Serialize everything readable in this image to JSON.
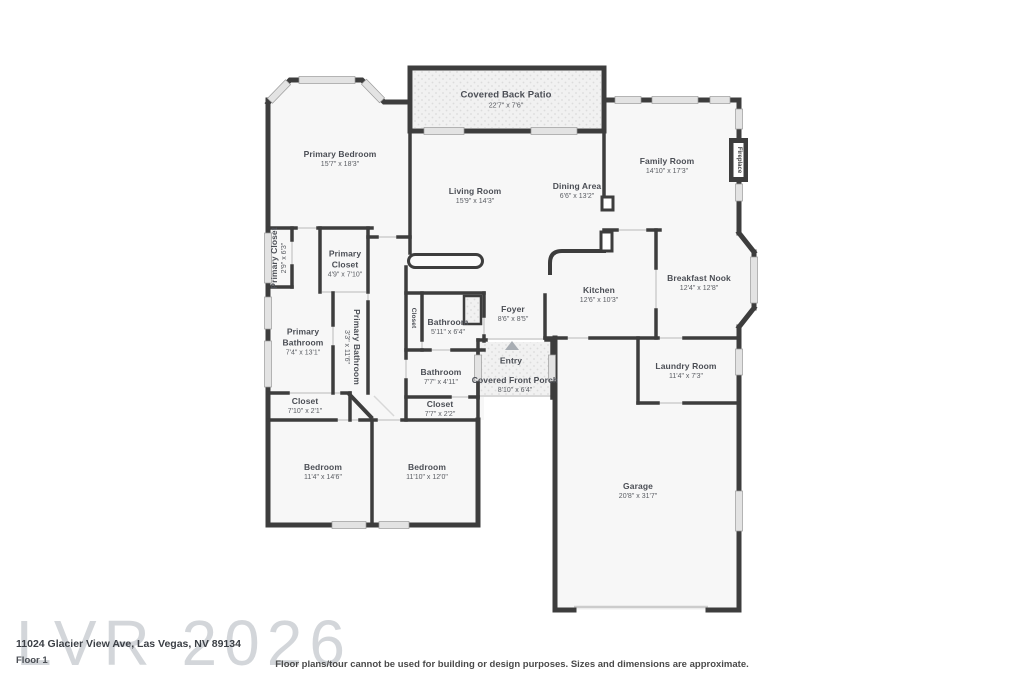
{
  "watermark": "LVR 2026",
  "address": {
    "line1": "11024 Glacier View Ave, Las Vegas, NV 89134",
    "line2": "Floor 1"
  },
  "footer": {
    "disclaimer": "Floor plans/tour cannot be used for building or design purposes. Sizes and dimensions are approximate."
  },
  "colors": {
    "wall": "#3d3d3d",
    "floor": "#f7f7f7",
    "patio_fill": "#f1f1f1",
    "window": "#e3e3e3",
    "label_text": "#4b4e55",
    "watermark": "#b7bcc2"
  },
  "rooms": {
    "covered_back_patio": {
      "name": "Covered Back Patio",
      "dims": "22'7\" x 7'6\""
    },
    "primary_bedroom": {
      "name": "Primary Bedroom",
      "dims": "15'7\" x 18'3\""
    },
    "family_room": {
      "name": "Family Room",
      "dims": "14'10\" x 17'3\""
    },
    "living_room": {
      "name": "Living Room",
      "dims": "15'9\" x 14'3\""
    },
    "dining_area": {
      "name": "Dining Area",
      "dims": "6'6\" x 13'2\""
    },
    "breakfast_nook": {
      "name": "Breakfast Nook",
      "dims": "12'4\" x 12'8\""
    },
    "kitchen": {
      "name": "Kitchen",
      "dims": "12'6\" x 10'3\""
    },
    "primary_closet_left": {
      "name": "Primary Closet",
      "dims": "2'9\" x 6'3\""
    },
    "primary_closet": {
      "name": "Primary Closet",
      "dims": "4'9\" x 7'10\""
    },
    "primary_bathroom": {
      "name": "Primary Bathroom",
      "dims": "7'4\" x 13'1\""
    },
    "primary_bathroom_hall": {
      "name": "Primary Bathroom",
      "dims": "3'3\" x 11'6\""
    },
    "closet_hall": {
      "name": "Closet"
    },
    "bathroom_upper": {
      "name": "Bathroom",
      "dims": "5'11\" x 6'4\""
    },
    "foyer": {
      "name": "Foyer",
      "dims": "8'6\" x 8'5\""
    },
    "entry": {
      "name": "Entry"
    },
    "covered_front_porch": {
      "name": "Covered Front Porch",
      "dims": "8'10\" x 6'4\""
    },
    "bathroom_lower": {
      "name": "Bathroom",
      "dims": "7'7\" x 4'11\""
    },
    "closet_lower": {
      "name": "Closet",
      "dims": "7'7\" x 2'2\""
    },
    "closet_left": {
      "name": "Closet",
      "dims": "7'10\" x 2'1\""
    },
    "bedroom_left": {
      "name": "Bedroom",
      "dims": "11'4\" x 14'6\""
    },
    "bedroom_right": {
      "name": "Bedroom",
      "dims": "11'10\" x 12'0\""
    },
    "laundry_room": {
      "name": "Laundry Room",
      "dims": "11'4\" x 7'3\""
    },
    "garage": {
      "name": "Garage",
      "dims": "20'8\" x 31'7\""
    },
    "fireplace": {
      "name": "Fireplace"
    }
  }
}
